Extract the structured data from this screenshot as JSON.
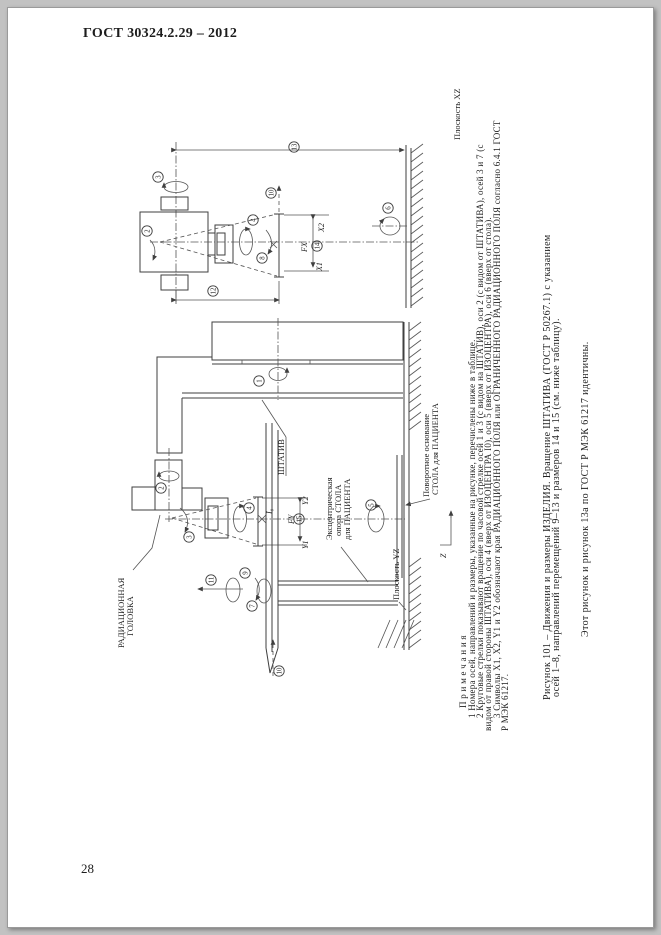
{
  "page": {
    "header_title": "ГОСТ 30324.2.29 – 2012",
    "page_number": "28"
  },
  "figure": {
    "labels": {
      "radiation_head_1": "РАДИАЦИОННАЯ",
      "radiation_head_2": "ГОЛОВКА",
      "stand": "ШТАТИВ",
      "eccentric_1": "Эксцентрическая",
      "eccentric_2": "опора СТОЛА",
      "eccentric_3": "для ПАЦИЕНТА",
      "turntable_1": "Поворотное основание",
      "turntable_2": "СТОЛА для ПАЦИЕНТА",
      "plane_xz": "Плоскость XZ",
      "plane_yz": "Плоскость YZ",
      "x1": "X1",
      "x2": "X2",
      "fx": "FX",
      "y1": "Y1",
      "y2": "Y2",
      "fy": "FY",
      "isocentre": "I₀",
      "z_axis": "Z"
    },
    "markers": [
      {
        "n": "13",
        "x": 294,
        "y": 147
      },
      {
        "n": "3",
        "x": 158,
        "y": 177
      },
      {
        "n": "2",
        "x": 147,
        "y": 231
      },
      {
        "n": "4",
        "x": 253,
        "y": 220
      },
      {
        "n": "8",
        "x": 262,
        "y": 258
      },
      {
        "n": "10",
        "x": 271,
        "y": 193
      },
      {
        "n": "14",
        "x": 317,
        "y": 246
      },
      {
        "n": "12",
        "x": 213,
        "y": 291
      },
      {
        "n": "6",
        "x": 388,
        "y": 208
      },
      {
        "n": "1",
        "x": 259,
        "y": 381
      },
      {
        "n": "2",
        "x": 161,
        "y": 488
      },
      {
        "n": "3",
        "x": 189,
        "y": 537
      },
      {
        "n": "4",
        "x": 249,
        "y": 508
      },
      {
        "n": "5",
        "x": 371,
        "y": 505
      },
      {
        "n": "7",
        "x": 252,
        "y": 606
      },
      {
        "n": "9",
        "x": 245,
        "y": 573
      },
      {
        "n": "11",
        "x": 211,
        "y": 580
      },
      {
        "n": "10",
        "x": 279,
        "y": 671
      },
      {
        "n": "15",
        "x": 299,
        "y": 519
      }
    ]
  },
  "notes": {
    "header": "П р и м е ч а н и я",
    "lines": [
      "1 Номера осей, направлений и размеры, указанные на рисунке, перечислены ниже в таблице.",
      "2 Круговые стрелки показывают вращение по часовой стрелке осей 1 и 3 (с видом на ШТАТИВ), оси 2 (с видом от ШТАТИВА), осей 3 и 7 (с",
      "видом от правой стороны ШТАТИВА), оси 4 (вверх от ИЗОЦЕНТРА I0), оси 5 (вверх от ИЗОЦЕНТРА), оси 6 (вверх от стола).",
      "3 Символы X1, X2, Y1 и Y2 обозначают края РАДИАЦИОННОГО ПОЛЯ или ОГРАНИЧЕННОГО РАДИАЦИОННОГО ПОЛЯ согласно 6.4.1 ГОСТ",
      "Р МЭК 61217."
    ]
  },
  "caption": {
    "line1": "Рисунок 101 – Движения и размеры ИЗДЕЛИЯ. Вращение ШТАТИВА (ГОСТ Р 50267.1) с указанием",
    "line2": "осей 1–8, направлений перемещений 9–13 и размеров 14 и 15 (см. ниже таблицу).",
    "line3": "Этот рисунок и рисунок 13а по ГОСТ Р МЭК 61217 идентичны."
  }
}
